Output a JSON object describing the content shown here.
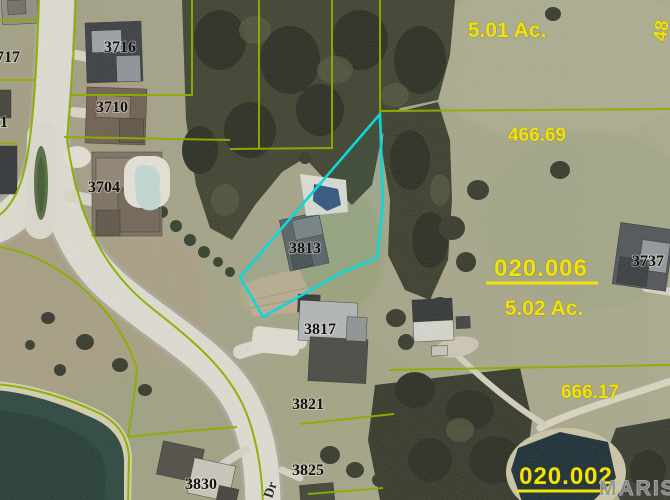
{
  "labels": {
    "acreage_501": "5.01 Ac.",
    "dim_466": "466.69",
    "parcel_006": "020.006",
    "acreage_502": "5.02 Ac.",
    "dim_666": "666.17",
    "parcel_002": "020.002",
    "edge_partial": "48"
  },
  "houses": {
    "h717": "717",
    "h1": "1",
    "h3716": "3716",
    "h3710": "3710",
    "h3704": "3704",
    "h3813": "3813",
    "h3737": "3737",
    "h3817": "3817",
    "h3821": "3821",
    "h3825": "3825",
    "h3830": "3830"
  },
  "road": {
    "label": "Dr"
  },
  "watermark": "MARIS",
  "colors": {
    "parcel_line": "#8ab000",
    "highlight_cyan": "#0dd8d8",
    "label_yellow": "#f2e205"
  }
}
